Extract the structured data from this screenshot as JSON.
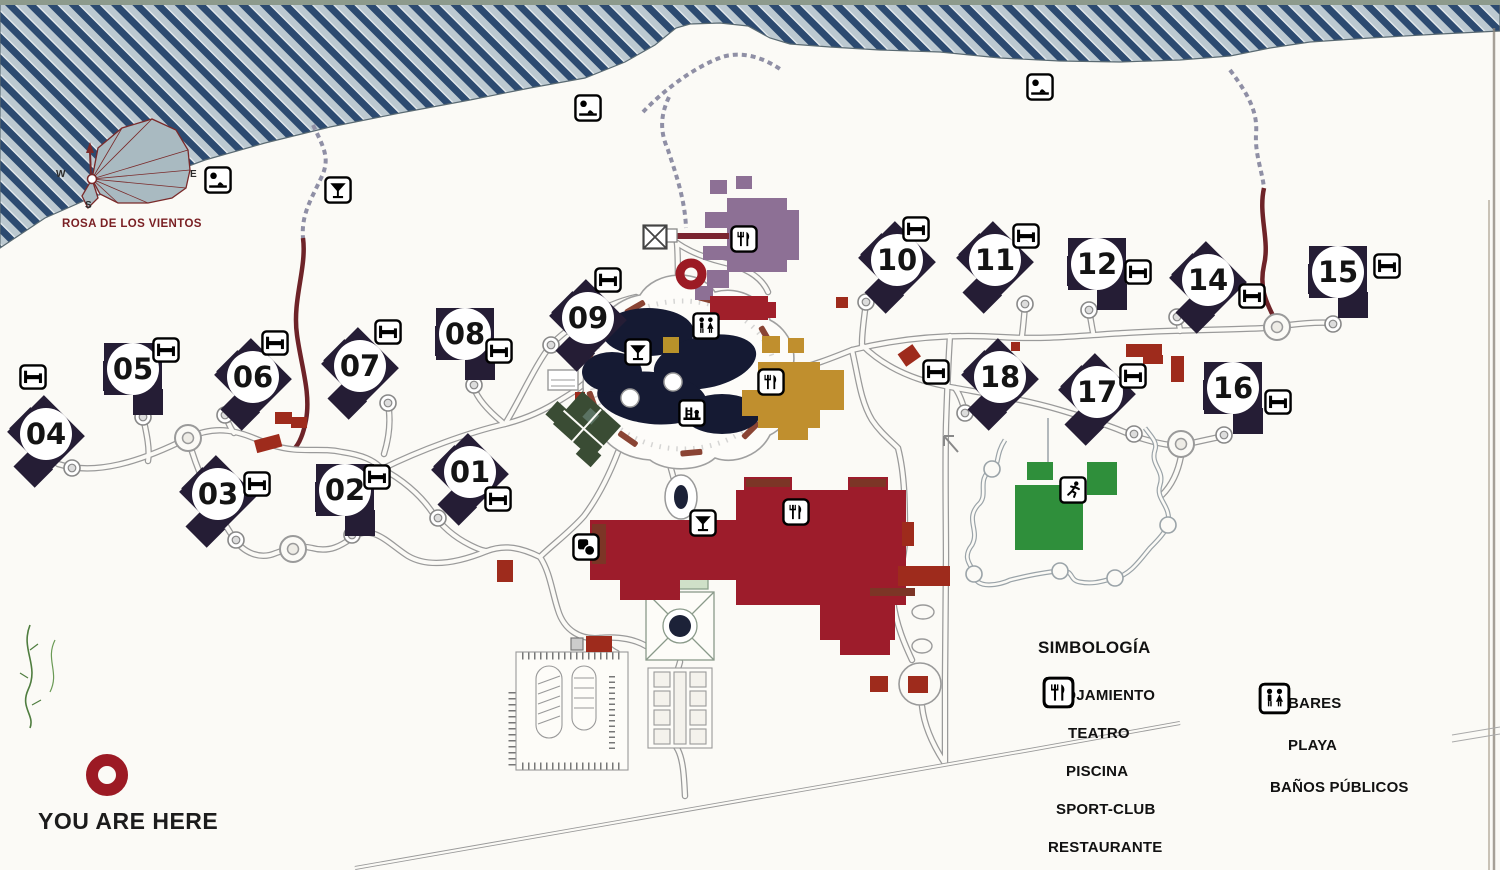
{
  "map_title": "resort-site-map",
  "compass": {
    "title": "ROSA DE LOS VIENTOS",
    "west": "W",
    "east": "E",
    "south": "S"
  },
  "you_are_here": {
    "label": "YOU ARE HERE"
  },
  "legend": {
    "title": "SIMBOLOGÍA",
    "columns": [
      [
        {
          "icon": "bed",
          "label": "ALOJAMIENTO",
          "indent": 2
        },
        {
          "icon": "theater",
          "label": "TEATRO",
          "indent": 26
        },
        {
          "icon": "pool",
          "label": "PISCINA",
          "indent": 24
        },
        {
          "icon": "sport",
          "label": "SPORT-CLUB",
          "indent": 14
        },
        {
          "icon": "restaurant",
          "label": "RESTAURANTE",
          "indent": 6
        }
      ],
      [
        {
          "icon": "bar",
          "label": "BARES",
          "indent": 30
        },
        {
          "icon": "beach",
          "label": "PLAYA",
          "indent": 30
        },
        {
          "icon": "wc",
          "label": "BAÑOS PÚBLICOS",
          "indent": 12
        }
      ]
    ]
  },
  "buildings": [
    {
      "number": "01",
      "x": 470,
      "y": 472,
      "rot": 45
    },
    {
      "number": "02",
      "x": 345,
      "y": 490,
      "rot": 0
    },
    {
      "number": "03",
      "x": 218,
      "y": 494,
      "rot": 45
    },
    {
      "number": "04",
      "x": 46,
      "y": 434,
      "rot": 45
    },
    {
      "number": "05",
      "x": 133,
      "y": 369,
      "rot": 0
    },
    {
      "number": "06",
      "x": 253,
      "y": 377,
      "rot": 45
    },
    {
      "number": "07",
      "x": 360,
      "y": 366,
      "rot": 45
    },
    {
      "number": "08",
      "x": 465,
      "y": 334,
      "rot": 0
    },
    {
      "number": "09",
      "x": 588,
      "y": 318,
      "rot": 45
    },
    {
      "number": "10",
      "x": 897,
      "y": 260,
      "rot": 45
    },
    {
      "number": "11",
      "x": 995,
      "y": 260,
      "rot": 45
    },
    {
      "number": "12",
      "x": 1097,
      "y": 264,
      "rot": 0
    },
    {
      "number": "14",
      "x": 1208,
      "y": 280,
      "rot": 45
    },
    {
      "number": "15",
      "x": 1338,
      "y": 272,
      "rot": 0
    },
    {
      "number": "16",
      "x": 1233,
      "y": 388,
      "rot": 0
    },
    {
      "number": "17",
      "x": 1097,
      "y": 392,
      "rot": 45
    },
    {
      "number": "18",
      "x": 1000,
      "y": 377,
      "rot": 45
    }
  ],
  "map_icons": [
    {
      "type": "bed",
      "x": 498,
      "y": 499
    },
    {
      "type": "bed",
      "x": 377,
      "y": 477
    },
    {
      "type": "bed",
      "x": 257,
      "y": 484
    },
    {
      "type": "bed",
      "x": 33,
      "y": 377
    },
    {
      "type": "bed",
      "x": 166,
      "y": 350
    },
    {
      "type": "bed",
      "x": 275,
      "y": 343
    },
    {
      "type": "bed",
      "x": 388,
      "y": 332
    },
    {
      "type": "bed",
      "x": 499,
      "y": 351
    },
    {
      "type": "bed",
      "x": 608,
      "y": 280
    },
    {
      "type": "bed",
      "x": 916,
      "y": 229
    },
    {
      "type": "bed",
      "x": 1026,
      "y": 236
    },
    {
      "type": "bed",
      "x": 1138,
      "y": 272
    },
    {
      "type": "bed",
      "x": 1252,
      "y": 296
    },
    {
      "type": "bed",
      "x": 1387,
      "y": 266
    },
    {
      "type": "bed",
      "x": 1278,
      "y": 402
    },
    {
      "type": "bed",
      "x": 1133,
      "y": 376
    },
    {
      "type": "bed",
      "x": 936,
      "y": 372
    },
    {
      "type": "bar",
      "x": 338,
      "y": 190
    },
    {
      "type": "bar",
      "x": 638,
      "y": 352
    },
    {
      "type": "bar",
      "x": 703,
      "y": 523
    },
    {
      "type": "beach",
      "x": 218,
      "y": 180
    },
    {
      "type": "beach",
      "x": 588,
      "y": 108
    },
    {
      "type": "beach",
      "x": 1040,
      "y": 87
    },
    {
      "type": "wc",
      "x": 706,
      "y": 326
    },
    {
      "type": "pool",
      "x": 692,
      "y": 413
    },
    {
      "type": "restaurant",
      "x": 744,
      "y": 239
    },
    {
      "type": "restaurant",
      "x": 771,
      "y": 382
    },
    {
      "type": "restaurant",
      "x": 796,
      "y": 512
    },
    {
      "type": "theater",
      "x": 586,
      "y": 547
    },
    {
      "type": "sport",
      "x": 1073,
      "y": 490
    },
    {
      "type": "dock",
      "x": 655,
      "y": 237
    }
  ],
  "markers": [
    {
      "x": 691,
      "y": 274,
      "r": 11,
      "w": 9
    },
    {
      "x": 107,
      "y": 775,
      "r": 15,
      "w": 12
    }
  ],
  "colors": {
    "ocean_dark": "#2c4a70",
    "ocean_light": "#bcc9d1",
    "building": "#251d35",
    "hotel_red": "#9d1c2b",
    "brick": "#9e2b1c",
    "gold": "#c08f2e",
    "purple": "#8d7095",
    "green": "#2f8f3b",
    "dark_green": "#3a4c34",
    "pool_water": "#151a33",
    "marker_red": "#9c1a24",
    "trail_red": "#6e2328"
  }
}
